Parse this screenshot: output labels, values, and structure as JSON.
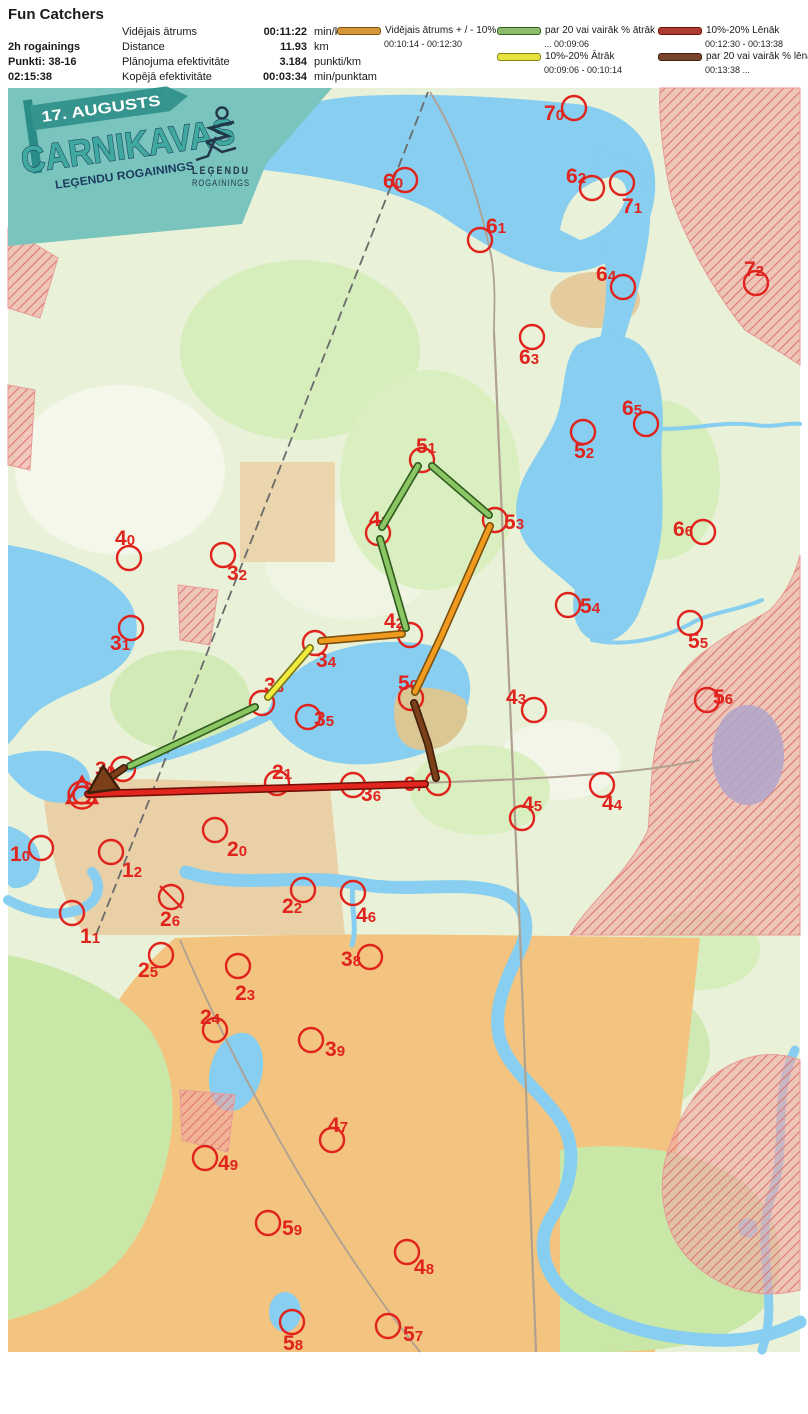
{
  "header": {
    "title": "Fun Catchers",
    "team": {
      "category": "2h rogainings",
      "points": "Punkti: 38-16",
      "time": "02:15:38"
    },
    "stats": [
      {
        "label": "Vidējais ātrums",
        "value": "00:11:22",
        "unit": "min/km"
      },
      {
        "label": "Distance",
        "value": "11.93",
        "unit": "km"
      },
      {
        "label": "Plānojuma efektivitāte",
        "value": "3.184",
        "unit": "punkti/km"
      },
      {
        "label": "Kopējā efektivitāte",
        "value": "00:03:34",
        "unit": "min/punktam"
      }
    ],
    "legend": [
      {
        "label": "Vidējais ātrums + / - 10%",
        "range": "00:10:14   -   00:12:30",
        "color": "#D6973B",
        "border": "#7C5210",
        "column": 1,
        "row": 1
      },
      {
        "label": "par 20 vai vairāk % ātrāk",
        "range": "...   00:09:06",
        "color": "#8CBB6C",
        "border": "#33611F",
        "column": 2,
        "row": 1
      },
      {
        "label": "10%-20% Ātrāk",
        "range": "00:09:06   -   00:10:14",
        "color": "#E6E23E",
        "border": "#88821D",
        "column": 2,
        "row": 2
      },
      {
        "label": "10%-20% Lēnāk",
        "range": "00:12:30   - 00:13:38",
        "color": "#AC3B32",
        "border": "#701109",
        "column": 3,
        "row": 1
      },
      {
        "label": "par 20 vai vairāk % lēnāk",
        "range": "00:13:38   ...",
        "color": "#77452B",
        "border": "#40200A",
        "column": 3,
        "row": 2
      }
    ]
  },
  "map": {
    "control_color": "#E0231C",
    "banner": {
      "date": "17. AUGUSTS",
      "title": "CARNIKAVAS",
      "subtitle": "LEĢENDU ROGAININGS",
      "logo_line1": "LEĢENDU",
      "logo_line2": "ROGAININGS"
    },
    "start": {
      "x": 82,
      "y": 795
    },
    "controls": [
      {
        "n": "70",
        "cx": 574,
        "cy": 108,
        "lx": 544,
        "ly": 120
      },
      {
        "n": "60",
        "cx": 405,
        "cy": 180,
        "lx": 383,
        "ly": 188
      },
      {
        "n": "62",
        "cx": 592,
        "cy": 188,
        "lx": 566,
        "ly": 183
      },
      {
        "n": "71",
        "cx": 622,
        "cy": 183,
        "lx": 622,
        "ly": 213
      },
      {
        "n": "61",
        "cx": 480,
        "cy": 240,
        "lx": 486,
        "ly": 233
      },
      {
        "n": "64",
        "cx": 623,
        "cy": 287,
        "lx": 596,
        "ly": 281
      },
      {
        "n": "72",
        "cx": 756,
        "cy": 283,
        "lx": 744,
        "ly": 276
      },
      {
        "n": "63",
        "cx": 532,
        "cy": 337,
        "lx": 519,
        "ly": 364
      },
      {
        "n": "65",
        "cx": 646,
        "cy": 424,
        "lx": 622,
        "ly": 415
      },
      {
        "n": "52",
        "cx": 583,
        "cy": 432,
        "lx": 574,
        "ly": 458
      },
      {
        "n": "51",
        "cx": 422,
        "cy": 460,
        "lx": 416,
        "ly": 453
      },
      {
        "n": "41",
        "cx": 378,
        "cy": 533,
        "lx": 369,
        "ly": 526
      },
      {
        "n": "53",
        "cx": 495,
        "cy": 520,
        "lx": 504,
        "ly": 529
      },
      {
        "n": "40",
        "cx": 129,
        "cy": 558,
        "lx": 115,
        "ly": 545
      },
      {
        "n": "32",
        "cx": 223,
        "cy": 555,
        "lx": 227,
        "ly": 580
      },
      {
        "n": "66",
        "cx": 703,
        "cy": 532,
        "lx": 673,
        "ly": 536
      },
      {
        "n": "54",
        "cx": 568,
        "cy": 605,
        "lx": 580,
        "ly": 613
      },
      {
        "n": "31",
        "cx": 131,
        "cy": 628,
        "lx": 110,
        "ly": 650
      },
      {
        "n": "42",
        "cx": 410,
        "cy": 635,
        "lx": 384,
        "ly": 628
      },
      {
        "n": "55",
        "cx": 690,
        "cy": 623,
        "lx": 688,
        "ly": 648
      },
      {
        "n": "34",
        "cx": 315,
        "cy": 643,
        "lx": 316,
        "ly": 667
      },
      {
        "n": "33",
        "cx": 262,
        "cy": 703,
        "lx": 264,
        "ly": 692
      },
      {
        "n": "43",
        "cx": 534,
        "cy": 710,
        "lx": 506,
        "ly": 704
      },
      {
        "n": "56",
        "cx": 707,
        "cy": 700,
        "lx": 713,
        "ly": 704
      },
      {
        "n": "50",
        "cx": 411,
        "cy": 698,
        "lx": 398,
        "ly": 690
      },
      {
        "n": "35",
        "cx": 308,
        "cy": 717,
        "lx": 314,
        "ly": 726
      },
      {
        "n": "30",
        "cx": 123,
        "cy": 769,
        "lx": 95,
        "ly": 776
      },
      {
        "n": "21",
        "cx": 277,
        "cy": 783,
        "lx": 272,
        "ly": 779
      },
      {
        "n": "36",
        "cx": 353,
        "cy": 785,
        "lx": 361,
        "ly": 801
      },
      {
        "n": "37",
        "cx": 438,
        "cy": 783,
        "lx": 404,
        "ly": 791
      },
      {
        "n": "45",
        "cx": 522,
        "cy": 818,
        "lx": 522,
        "ly": 811
      },
      {
        "n": "44",
        "cx": 602,
        "cy": 785,
        "lx": 602,
        "ly": 810
      },
      {
        "n": "10",
        "cx": 41,
        "cy": 848,
        "lx": 10,
        "ly": 861
      },
      {
        "n": "12",
        "cx": 111,
        "cy": 852,
        "lx": 122,
        "ly": 877
      },
      {
        "n": "20",
        "cx": 215,
        "cy": 830,
        "lx": 227,
        "ly": 856
      },
      {
        "n": "26",
        "cx": 171,
        "cy": 897,
        "lx": 160,
        "ly": 926,
        "crossed": true
      },
      {
        "n": "22",
        "cx": 303,
        "cy": 890,
        "lx": 282,
        "ly": 913
      },
      {
        "n": "11",
        "cx": 72,
        "cy": 913,
        "lx": 80,
        "ly": 943
      },
      {
        "n": "46",
        "cx": 353,
        "cy": 893,
        "lx": 356,
        "ly": 922
      },
      {
        "n": "25",
        "cx": 161,
        "cy": 955,
        "lx": 138,
        "ly": 977
      },
      {
        "n": "38",
        "cx": 370,
        "cy": 957,
        "lx": 341,
        "ly": 966
      },
      {
        "n": "23",
        "cx": 238,
        "cy": 966,
        "lx": 235,
        "ly": 1000
      },
      {
        "n": "24",
        "cx": 215,
        "cy": 1030,
        "lx": 200,
        "ly": 1024
      },
      {
        "n": "39",
        "cx": 311,
        "cy": 1040,
        "lx": 325,
        "ly": 1056
      },
      {
        "n": "47",
        "cx": 332,
        "cy": 1140,
        "lx": 328,
        "ly": 1132
      },
      {
        "n": "49",
        "cx": 205,
        "cy": 1158,
        "lx": 218,
        "ly": 1170
      },
      {
        "n": "59",
        "cx": 268,
        "cy": 1223,
        "lx": 282,
        "ly": 1235
      },
      {
        "n": "48",
        "cx": 407,
        "cy": 1252,
        "lx": 414,
        "ly": 1274
      },
      {
        "n": "58",
        "cx": 292,
        "cy": 1322,
        "lx": 283,
        "ly": 1350
      },
      {
        "n": "57",
        "cx": 388,
        "cy": 1326,
        "lx": 403,
        "ly": 1341
      }
    ],
    "route": {
      "styles": {
        "avg": {
          "stroke": "#F09A1E",
          "outline": "#7C5210"
        },
        "faster20": {
          "stroke": "#8AC663",
          "outline": "#2F5A1D"
        },
        "faster1020": {
          "stroke": "#F1EB3E",
          "outline": "#77741A"
        },
        "slower1020": {
          "stroke": "#E3261D",
          "outline": "#701109"
        },
        "slower20": {
          "stroke": "#7B4019",
          "outline": "#40200A"
        }
      },
      "segments": [
        {
          "cat": "slower1020",
          "pts": [
            [
              88,
              794
            ],
            [
              425,
              784
            ]
          ]
        },
        {
          "cat": "slower20",
          "pts": [
            [
              436,
              778
            ],
            [
              428,
              744
            ],
            [
              414,
              703
            ]
          ]
        },
        {
          "cat": "avg",
          "pts": [
            [
              415,
              692
            ],
            [
              441,
              637
            ],
            [
              490,
              526
            ]
          ]
        },
        {
          "cat": "faster20",
          "pts": [
            [
              489,
              515
            ],
            [
              432,
              466
            ]
          ]
        },
        {
          "cat": "faster20",
          "pts": [
            [
              418,
              466
            ],
            [
              382,
              527
            ]
          ]
        },
        {
          "cat": "faster20",
          "pts": [
            [
              380,
              539
            ],
            [
              406,
              628
            ]
          ]
        },
        {
          "cat": "avg",
          "pts": [
            [
              402,
              634
            ],
            [
              321,
              641
            ]
          ]
        },
        {
          "cat": "faster1020",
          "pts": [
            [
              310,
              648
            ],
            [
              268,
              697
            ]
          ]
        },
        {
          "cat": "faster20",
          "pts": [
            [
              255,
              707
            ],
            [
              130,
              766
            ]
          ]
        }
      ],
      "arrow": {
        "cat": "slower20",
        "shaft": [
          [
            124,
            768
          ],
          [
            108,
            779
          ]
        ],
        "head": "88,793 119,789 103,766"
      }
    }
  }
}
